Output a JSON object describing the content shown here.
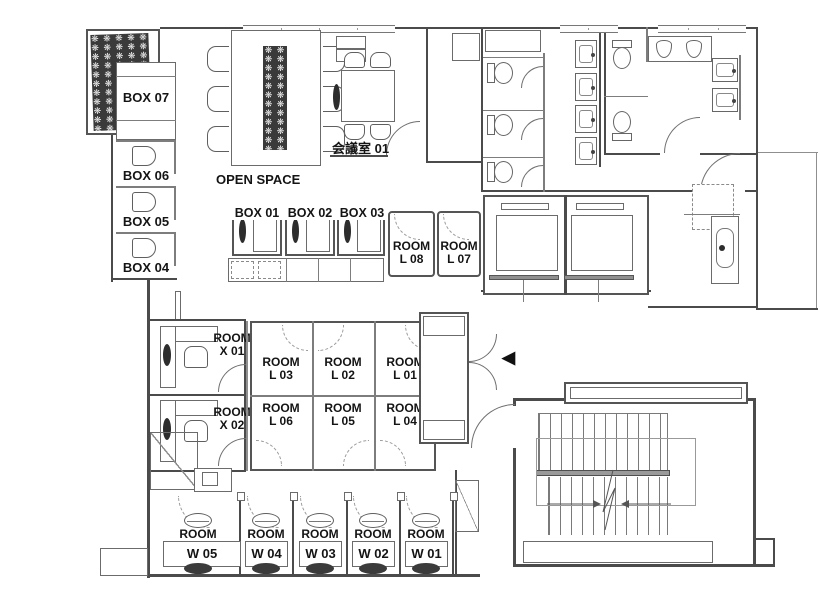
{
  "plan": {
    "title": "office-floor-plan",
    "colors": {
      "wall": "#4b4b4b",
      "line": "#777777",
      "dark_fixture": "#2d2d2d",
      "background": "#ffffff"
    },
    "labels": {
      "open_space": "OPEN SPACE",
      "meeting_room": "会議室 01",
      "entry_marker": "◀",
      "planter_char": "❋"
    },
    "boxes": {
      "b07": "BOX 07",
      "b06": "BOX 06",
      "b05": "BOX 05",
      "b04": "BOX 04",
      "b01": "BOX 01",
      "b02": "BOX 02",
      "b03": "BOX 03"
    },
    "rooms": {
      "l01": {
        "l1": "ROOM",
        "l2": "L 01"
      },
      "l02": {
        "l1": "ROOM",
        "l2": "L 02"
      },
      "l03": {
        "l1": "ROOM",
        "l2": "L 03"
      },
      "l04": {
        "l1": "ROOM",
        "l2": "L 04"
      },
      "l05": {
        "l1": "ROOM",
        "l2": "L 05"
      },
      "l06": {
        "l1": "ROOM",
        "l2": "L 06"
      },
      "l07": {
        "l1": "ROOM",
        "l2": "L 07"
      },
      "l08": {
        "l1": "ROOM",
        "l2": "L 08"
      },
      "x01": {
        "l1": "ROOM",
        "l2": "X 01"
      },
      "x02": {
        "l1": "ROOM",
        "l2": "X 02"
      },
      "w01": {
        "l1": "ROOM",
        "l2": "W 01"
      },
      "w02": {
        "l1": "ROOM",
        "l2": "W 02"
      },
      "w03": {
        "l1": "ROOM",
        "l2": "W 03"
      },
      "w04": {
        "l1": "ROOM",
        "l2": "W 04"
      },
      "w05": {
        "l1": "ROOM",
        "l2": "W 05"
      }
    }
  }
}
